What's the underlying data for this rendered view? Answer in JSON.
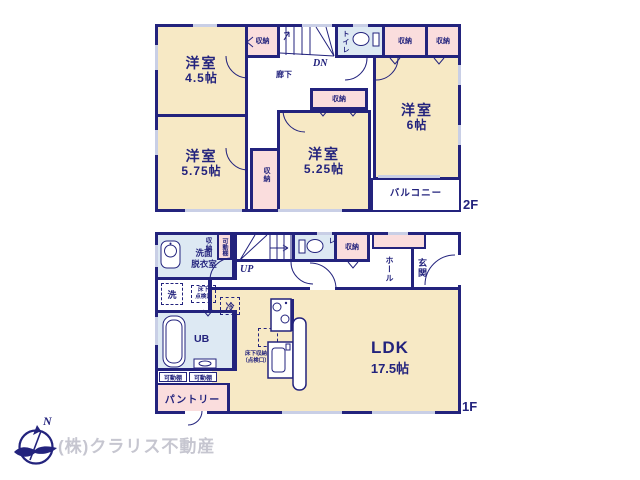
{
  "colors": {
    "wall": "#23237d",
    "room_cream": "#f7e9c5",
    "closet_pink": "#fadddd",
    "wet_blue": "#dde9f3",
    "window": "#c9cfe6",
    "label_navy": "#23237d",
    "company_gray": "#c6c6d0"
  },
  "icons": {
    "toilet": "toilet-icon",
    "washbasin": "washbasin-icon",
    "bathtub": "bathtub-icon",
    "stove": "stove-icon",
    "kitchen_sink": "kitchen-sink-icon",
    "counter": "counter-shape",
    "compass": "north-compass-icon",
    "stairs": "stairs-icon"
  },
  "floor2": {
    "floor_label": "2F",
    "room_45_name": "洋室",
    "room_45_size": "4.5帖",
    "room_575_name": "洋室",
    "room_575_size": "5.75帖",
    "room_525_name": "洋室",
    "room_525_size": "5.25帖",
    "room_6_name": "洋室",
    "room_6_size": "6帖",
    "closet": "収納",
    "corridor": "廊下",
    "toilet": "トイレ",
    "stairs_dn": "DN",
    "balcony": "バルコニー"
  },
  "floor1": {
    "floor_label": "1F",
    "ldk_name": "LDK",
    "ldk_size": "17.5帖",
    "washroom_line1": "洗面",
    "washroom_line2": "脱衣室",
    "closet": "収納",
    "movable_shelf": "可動棚",
    "stairs_up": "UP",
    "toilet": "トイレ",
    "hall": "ホール",
    "entrance": "玄関",
    "washer": "洗",
    "underfloor_hatch_line1": "床下",
    "underfloor_hatch_line2": "点検口",
    "unit_bath": "UB",
    "fridge": "冷",
    "counter": "カウンター",
    "floor_storage_line1": "床下収納",
    "floor_storage_line2": "（点検口）",
    "pantry": "パントリー"
  },
  "footer": {
    "company": "(株)クラリス不動産",
    "north_mark": "N"
  }
}
